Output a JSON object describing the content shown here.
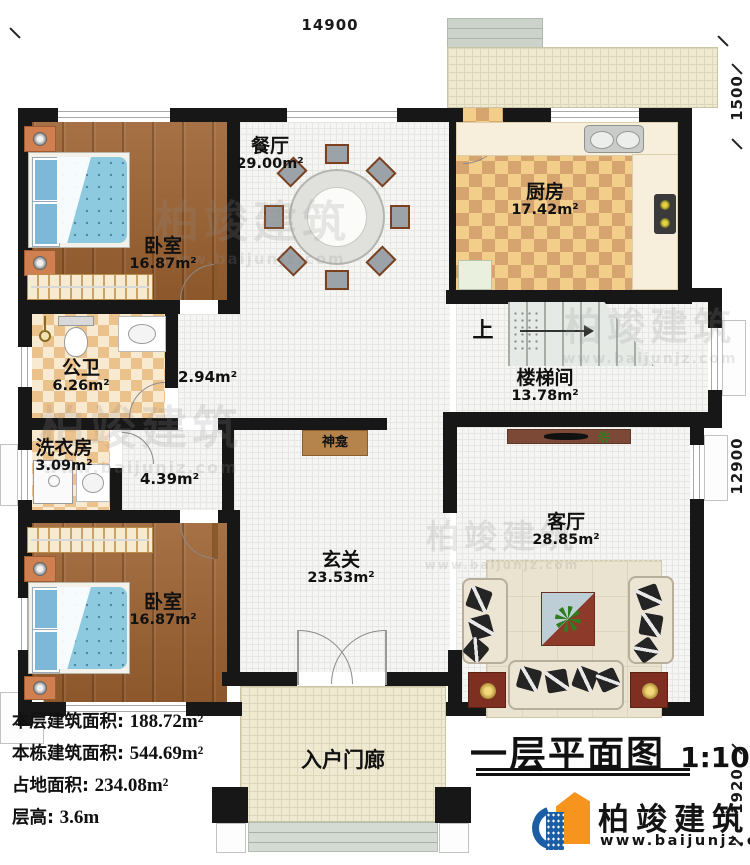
{
  "title": {
    "text": "一层平面图",
    "scale": "1:100"
  },
  "rooms": {
    "dining": {
      "name": "餐厅",
      "area": "29.00m²"
    },
    "kitchen": {
      "name": "厨房",
      "area": "17.42m²"
    },
    "bedroom_top": {
      "name": "卧室",
      "area": "16.87m²"
    },
    "bedroom_bottom": {
      "name": "卧室",
      "area": "16.87m²"
    },
    "bathroom": {
      "name": "公卫",
      "area": "6.26m²"
    },
    "laundry": {
      "name": "洗衣房",
      "area": "3.09m²"
    },
    "stairwell": {
      "name": "楼梯间",
      "area": "13.78m²"
    },
    "living": {
      "name": "客厅",
      "area": "28.85m²"
    },
    "foyer": {
      "name": "玄关",
      "area": "23.53m²"
    },
    "shrine": {
      "name": "神龛"
    },
    "porch": {
      "name": "入户门廊"
    }
  },
  "halls": {
    "small": "2.94m²",
    "large": "4.39m²"
  },
  "labels": {
    "stairs_up": "上"
  },
  "dimensions": {
    "top": "14900",
    "right_top": "1500",
    "right_middle": "12900",
    "right_bottom": "1920"
  },
  "stats": [
    {
      "label": "本层建筑面积:",
      "value": "188.72m²"
    },
    {
      "label": "本栋建筑面积:",
      "value": "544.69m²"
    },
    {
      "label": "占地面积:",
      "value": "234.08m²"
    },
    {
      "label": "层高:",
      "value": "3.6m"
    }
  ],
  "logo": {
    "name": "柏竣建筑",
    "url": "www.baijunjz.com"
  },
  "watermark": {
    "name": "柏竣建筑",
    "url": "www.baijunjz.com"
  },
  "colors": {
    "wall": "#171717",
    "wood_floor": "#9c6130",
    "kitchen_tile": "#d6a46e",
    "bath_tile": "#ecc28c",
    "bed_blue": "#82c0dc",
    "sofa": "#ece5d4",
    "coffee_table_red": "#8e3a2b",
    "shrine_cabinet": "#b5834c",
    "logo_blue": "#1b5ea6",
    "logo_orange": "#f7941d"
  }
}
